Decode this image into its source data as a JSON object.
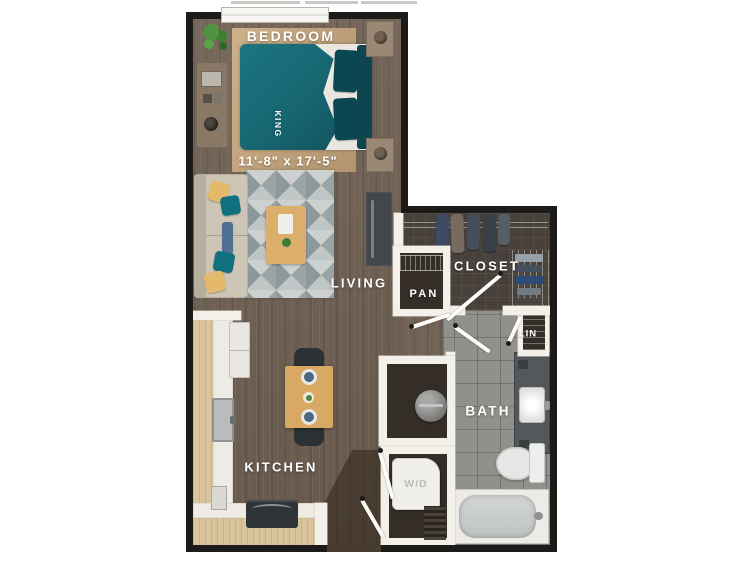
{
  "floorplan": {
    "rooms": {
      "bedroom": {
        "label": "BEDROOM",
        "dimensions": "11'-8\" x 17'-5\"",
        "bed_label": "KING"
      },
      "living": {
        "label": "LIVING"
      },
      "closet": {
        "label": "CLOSET"
      },
      "pantry": {
        "label": "PAN"
      },
      "linen": {
        "label": "LIN"
      },
      "bath": {
        "label": "BATH"
      },
      "kitchen": {
        "label": "KITCHEN"
      },
      "laundry": {
        "label": "W/D"
      }
    },
    "colors": {
      "exterior_wall": "#1d1b19",
      "interior_wall": "#f3f0e9",
      "wood_floor": "#6f6052",
      "tile_floor": "#90908c",
      "closet_floor": "#48403a",
      "bed_accent_teal": "#176672",
      "bedroom_rug_tan": "#c3a47f",
      "counter_wood": "#d9c49d",
      "label_text": "#ffffff"
    }
  }
}
